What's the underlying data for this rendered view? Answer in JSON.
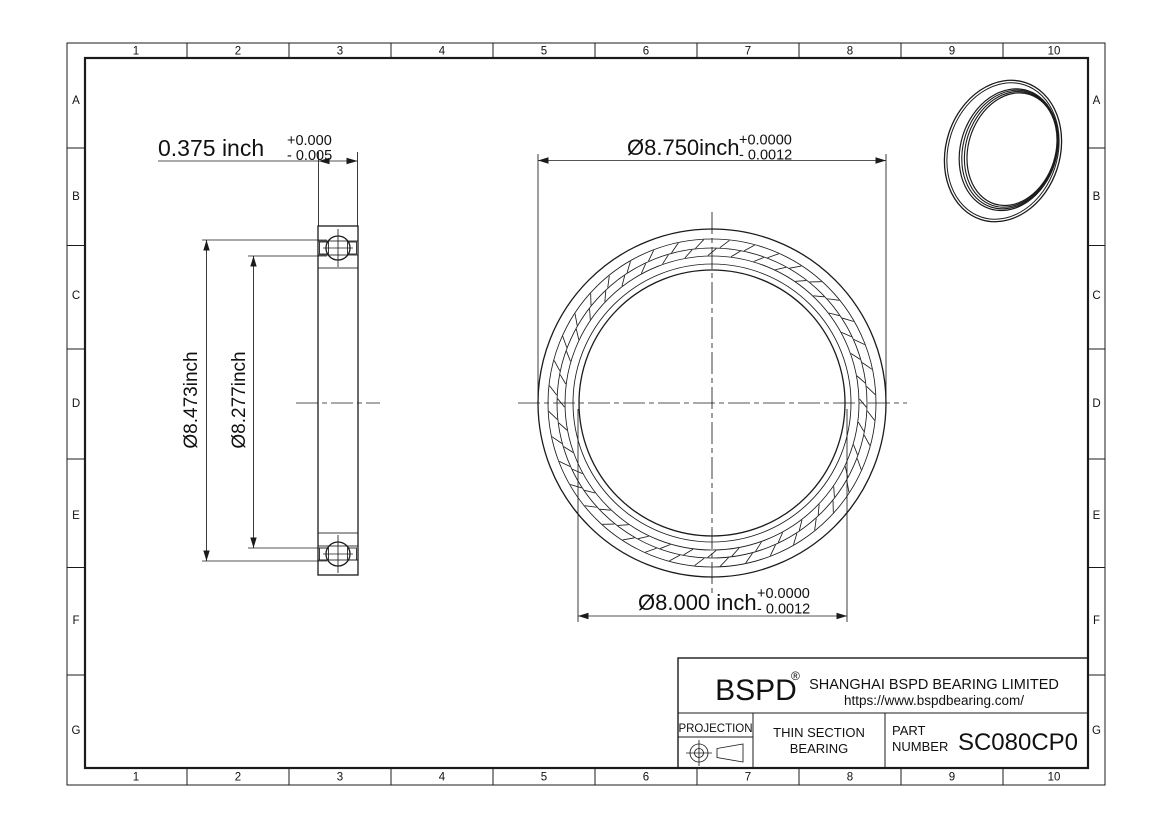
{
  "drawing": {
    "border": {
      "columns": [
        "1",
        "2",
        "3",
        "4",
        "5",
        "6",
        "7",
        "8",
        "9",
        "10"
      ],
      "rows": [
        "A",
        "B",
        "C",
        "D",
        "E",
        "F",
        "G"
      ]
    },
    "section_view": {
      "width_dim": {
        "value": "0.375 inch",
        "tol_plus": "+0.000",
        "tol_minus": "- 0.005"
      },
      "outer_race_dim": "Ø8.473inch",
      "inner_race_dim": "Ø8.277inch"
    },
    "front_view": {
      "outer_dim": {
        "value": "Ø8.750inch",
        "tol_plus": "+0.0000",
        "tol_minus": "- 0.0012"
      },
      "bore_dim": {
        "value": "Ø8.000 inch",
        "tol_plus": "+0.0000",
        "tol_minus": "- 0.0012"
      },
      "ticks": {
        "cx": 712,
        "cy": 403,
        "bands": [
          {
            "r1": 147.5,
            "r2": 154.5,
            "count": 40,
            "phase": 0,
            "tilt": 1.6
          },
          {
            "r1": 155.5,
            "r2": 163.5,
            "count": 40,
            "phase": 0.5,
            "tilt": 1.6
          }
        ]
      }
    },
    "title_block": {
      "logo": "BSPD",
      "registered_mark": "®",
      "company": "SHANGHAI BSPD BEARING LIMITED",
      "website": "https://www.bspdbearing.com/",
      "projection_label": "PROJECTION",
      "product_line1": "THIN SECTION",
      "product_line2": "BEARING",
      "part_label_line1": "PART",
      "part_label_line2": "NUMBER",
      "part_number": "SC080CP0"
    }
  }
}
